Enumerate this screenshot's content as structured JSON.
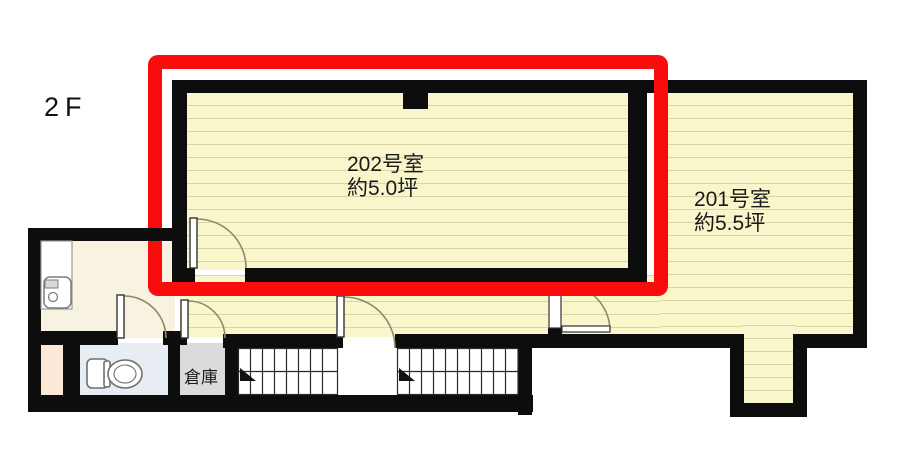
{
  "floor_label": "2F",
  "rooms": {
    "room202": {
      "name": "202号室",
      "area": "約5.0坪"
    },
    "room201": {
      "name": "201号室",
      "area": "約5.5坪"
    },
    "storage": {
      "name": "倉庫"
    }
  },
  "colors": {
    "highlight": "#f80c0c",
    "wall": "#0d0d0d",
    "floor_yellow": "#faf6cc",
    "floor_line": "#dcd4a4",
    "washroom_floor": "#f8f2e1",
    "toilet_floor": "#e8edf4",
    "storage_floor": "#dcdbdb",
    "entry_floor": "#fbe8d6"
  }
}
